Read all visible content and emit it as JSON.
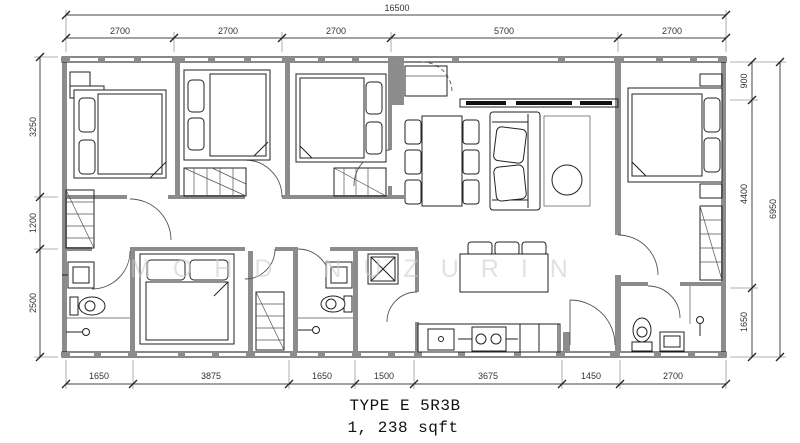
{
  "plan": {
    "type_label": "TYPE E 5R3B",
    "area_label": "1, 238 sqft",
    "watermark": "MOHD NUZURIN"
  },
  "dimensions": {
    "top_total": "16500",
    "top": [
      "2700",
      "2700",
      "2700",
      "5700",
      "2700"
    ],
    "left": [
      "3250",
      "1200",
      "2500"
    ],
    "right": [
      "900",
      "4400",
      "1650"
    ],
    "right_total": "6950",
    "bottom": [
      "1650",
      "3875",
      "1650",
      "1500",
      "3675",
      "1450",
      "2700"
    ]
  }
}
